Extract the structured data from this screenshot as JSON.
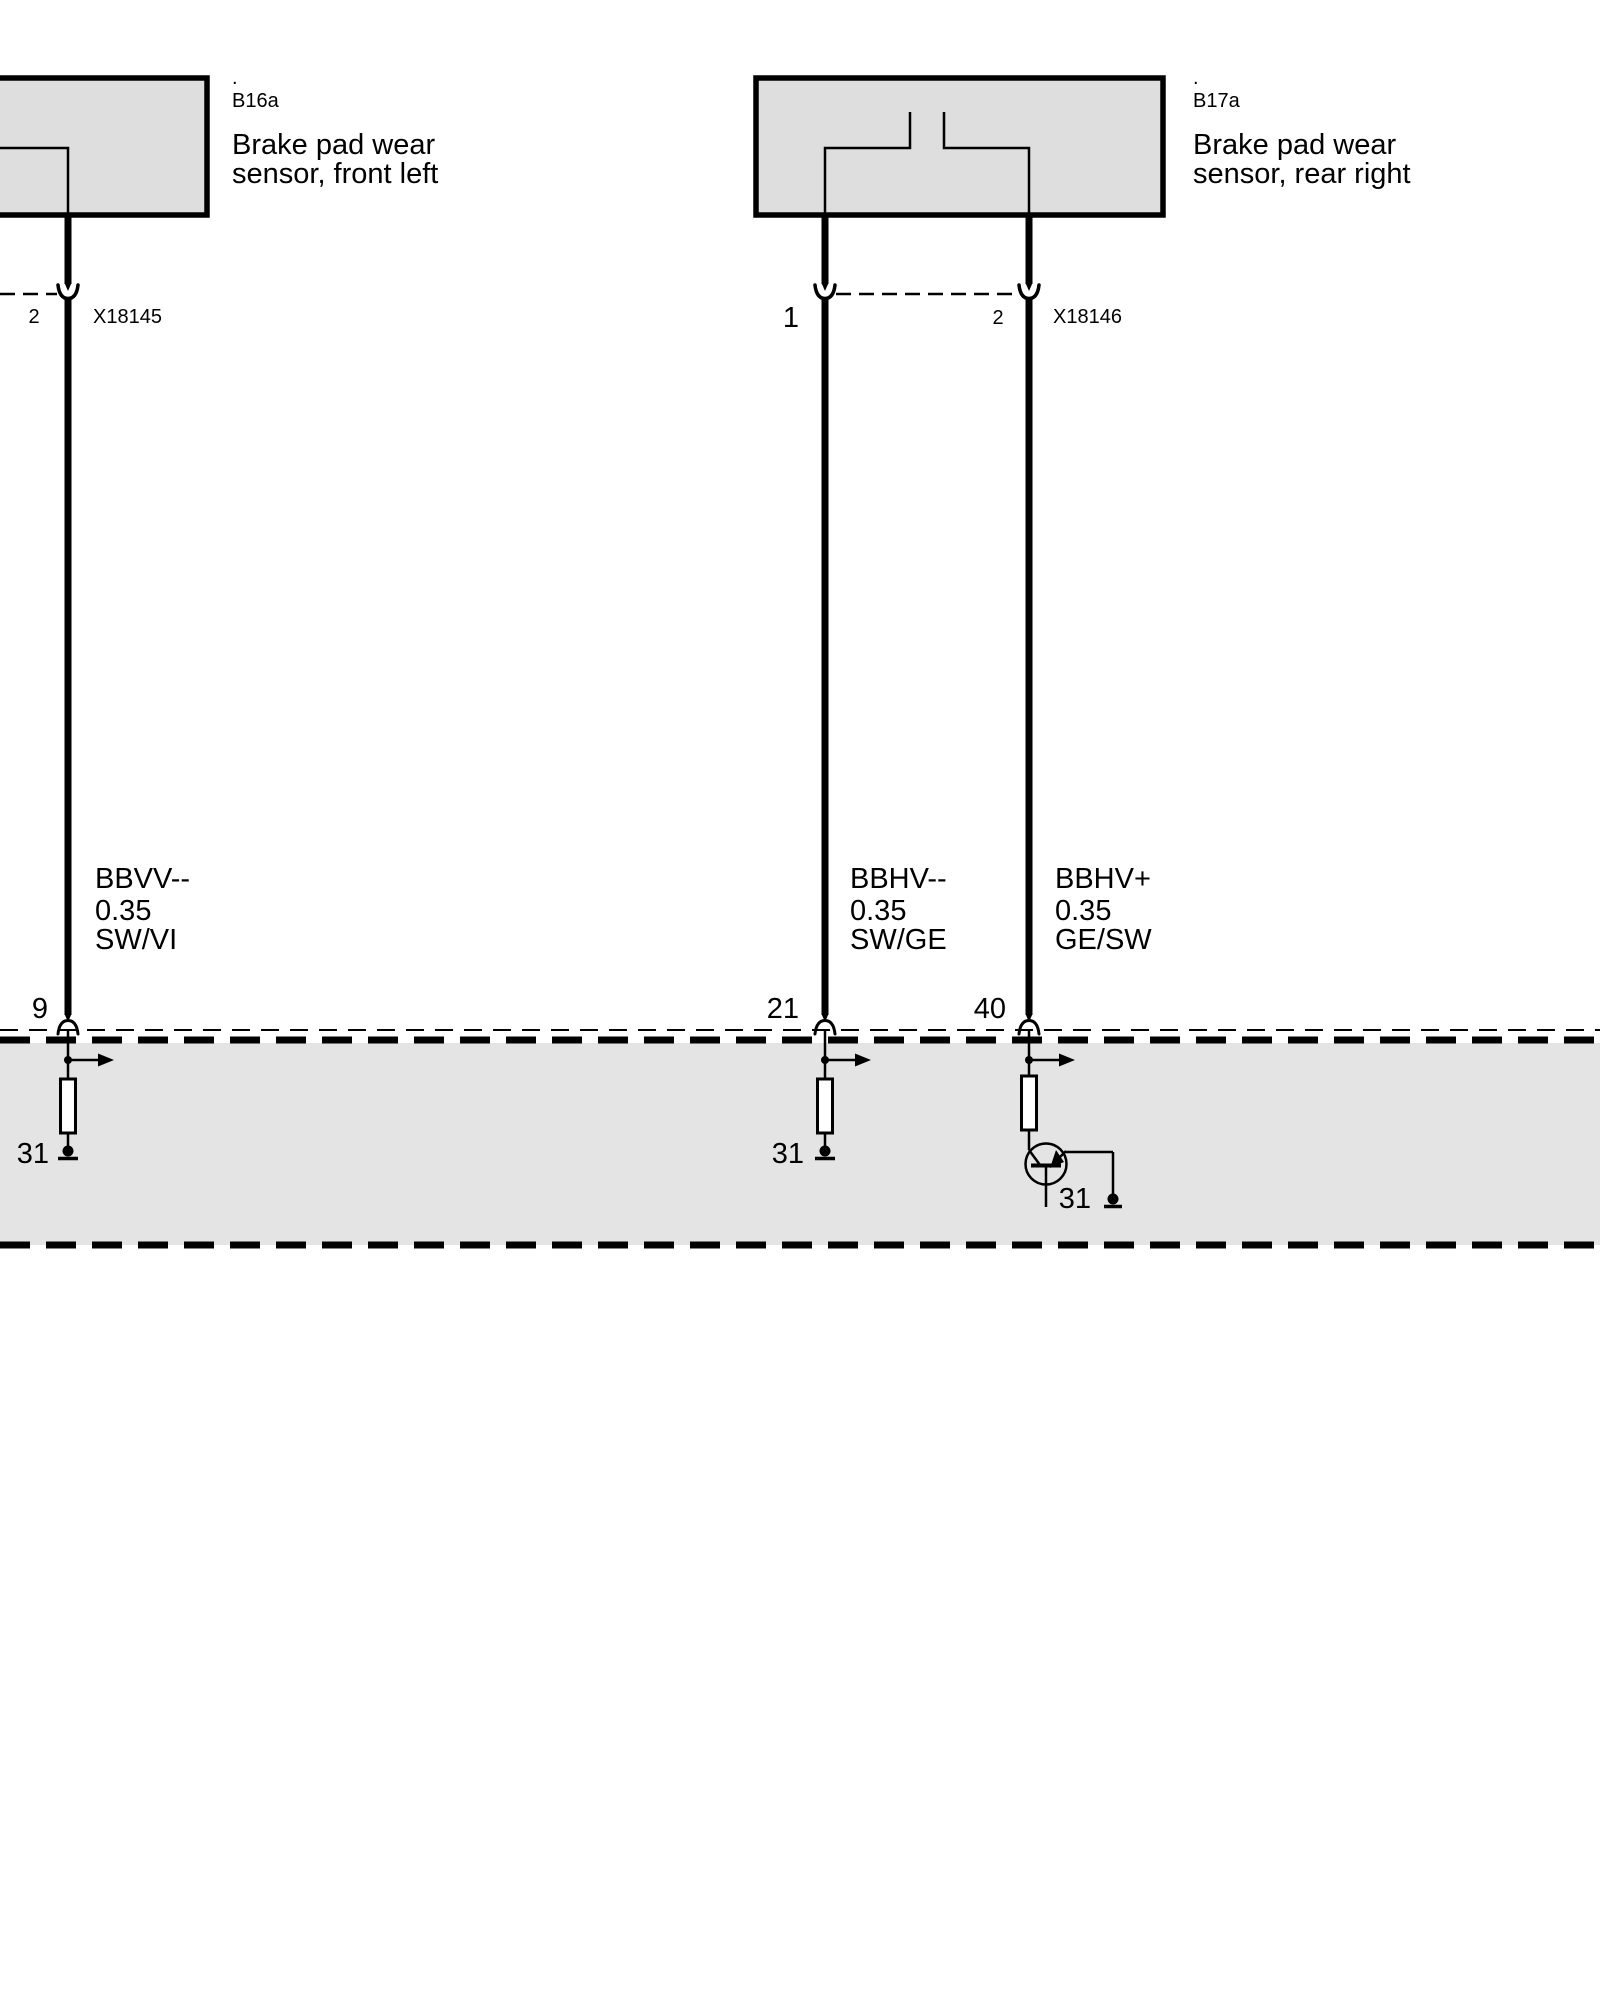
{
  "sensors": [
    {
      "dot": ".",
      "code": "B16a",
      "name1": "Brake pad wear",
      "name2": "sensor, front left"
    },
    {
      "dot": ".",
      "code": "B17a",
      "name1": "Brake pad wear",
      "name2": "sensor, rear right"
    }
  ],
  "connectors": [
    {
      "code": "X18145",
      "pin2": "2"
    },
    {
      "code": "X18146",
      "pin1": "1",
      "pin2": "2"
    }
  ],
  "wires": [
    {
      "name": "BBVV--",
      "gauge": "0.35",
      "color": "SW/VI",
      "pin": "9",
      "ground": "31"
    },
    {
      "name": "BBHV--",
      "gauge": "0.35",
      "color": "SW/GE",
      "pin": "21",
      "ground": "31"
    },
    {
      "name": "BBHV+",
      "gauge": "0.35",
      "color": "GE/SW",
      "pin": "40",
      "ground": "31"
    }
  ],
  "colors": {
    "component_fill": "#dedede",
    "module_band_fill": "#e4e4e4",
    "line": "#000000",
    "background": "#ffffff"
  }
}
